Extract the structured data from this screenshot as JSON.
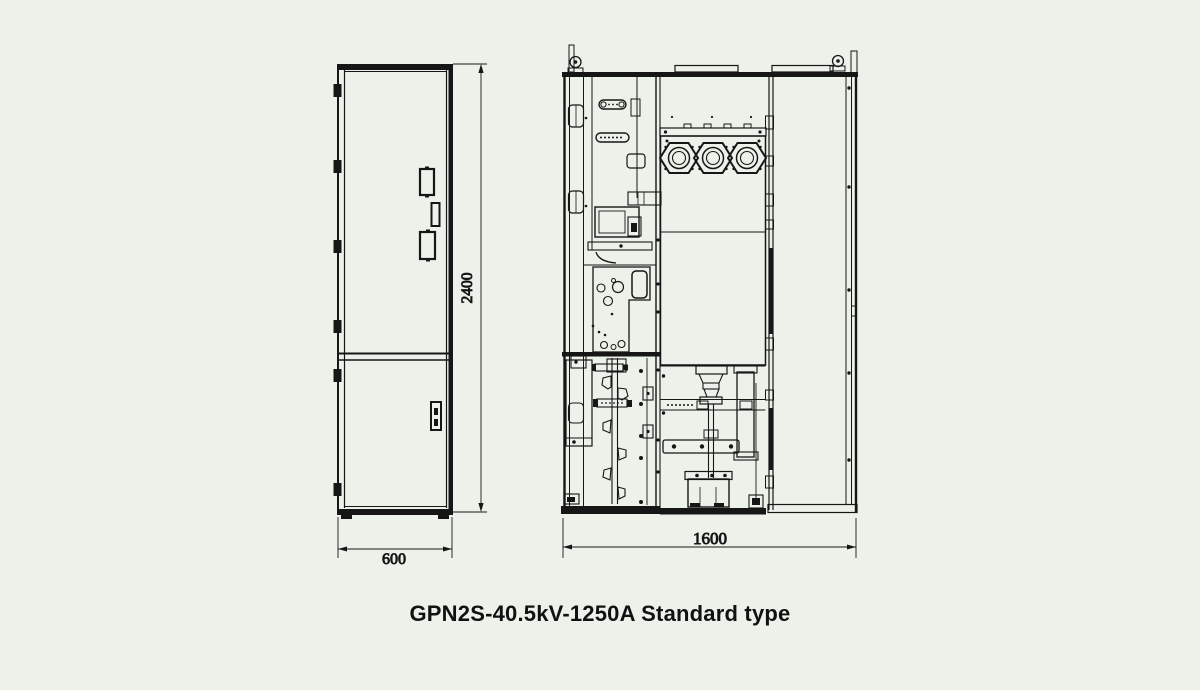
{
  "page": {
    "background": "#ecf2e9",
    "line_color": "#161616",
    "text_color": "#111111"
  },
  "caption": "GPN2S-40.5kV-1250A Standard type",
  "front_view": {
    "width_mm": "600",
    "height_mm": "2400"
  },
  "side_view": {
    "depth_mm": "1600"
  }
}
